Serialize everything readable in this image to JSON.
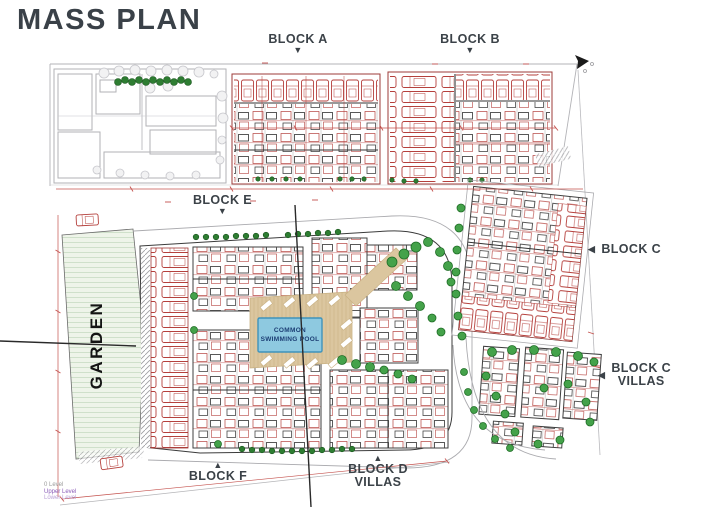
{
  "title": "MASS PLAN",
  "labels": {
    "block_a": "BLOCK A",
    "block_b": "BLOCK B",
    "block_c": "BLOCK C",
    "block_c_villas_line1": "BLOCK C",
    "block_c_villas_line2": "VILLAS",
    "block_d_villas_line1": "BLOCK D",
    "block_d_villas_line2": "VILLAS",
    "block_e": "BLOCK E",
    "block_f": "BLOCK F",
    "garden": "GARDEN",
    "pool_line1": "COMMON",
    "pool_line2": "SWIMMING POOL"
  },
  "legend": {
    "line1": "0 Level",
    "line2": "Upper Level",
    "line3": "Lower Level"
  },
  "icons": {
    "marker_up": "▲",
    "marker_down": "▼",
    "marker_left": "◀",
    "north_arrow": "north-arrow"
  },
  "colors": {
    "title_text": "#3a4148",
    "cad_red": "#b5403c",
    "tree_green": "#44a24a",
    "hedge_green": "#2e7d32",
    "garden_fill": "#eef4e9",
    "pool_deck": "#dbc69f",
    "pool_water": "#8ec9e0",
    "pool_text": "#1c3e74",
    "legend_purple": "#8a5bb8",
    "section_line": "#2a2a2a"
  }
}
